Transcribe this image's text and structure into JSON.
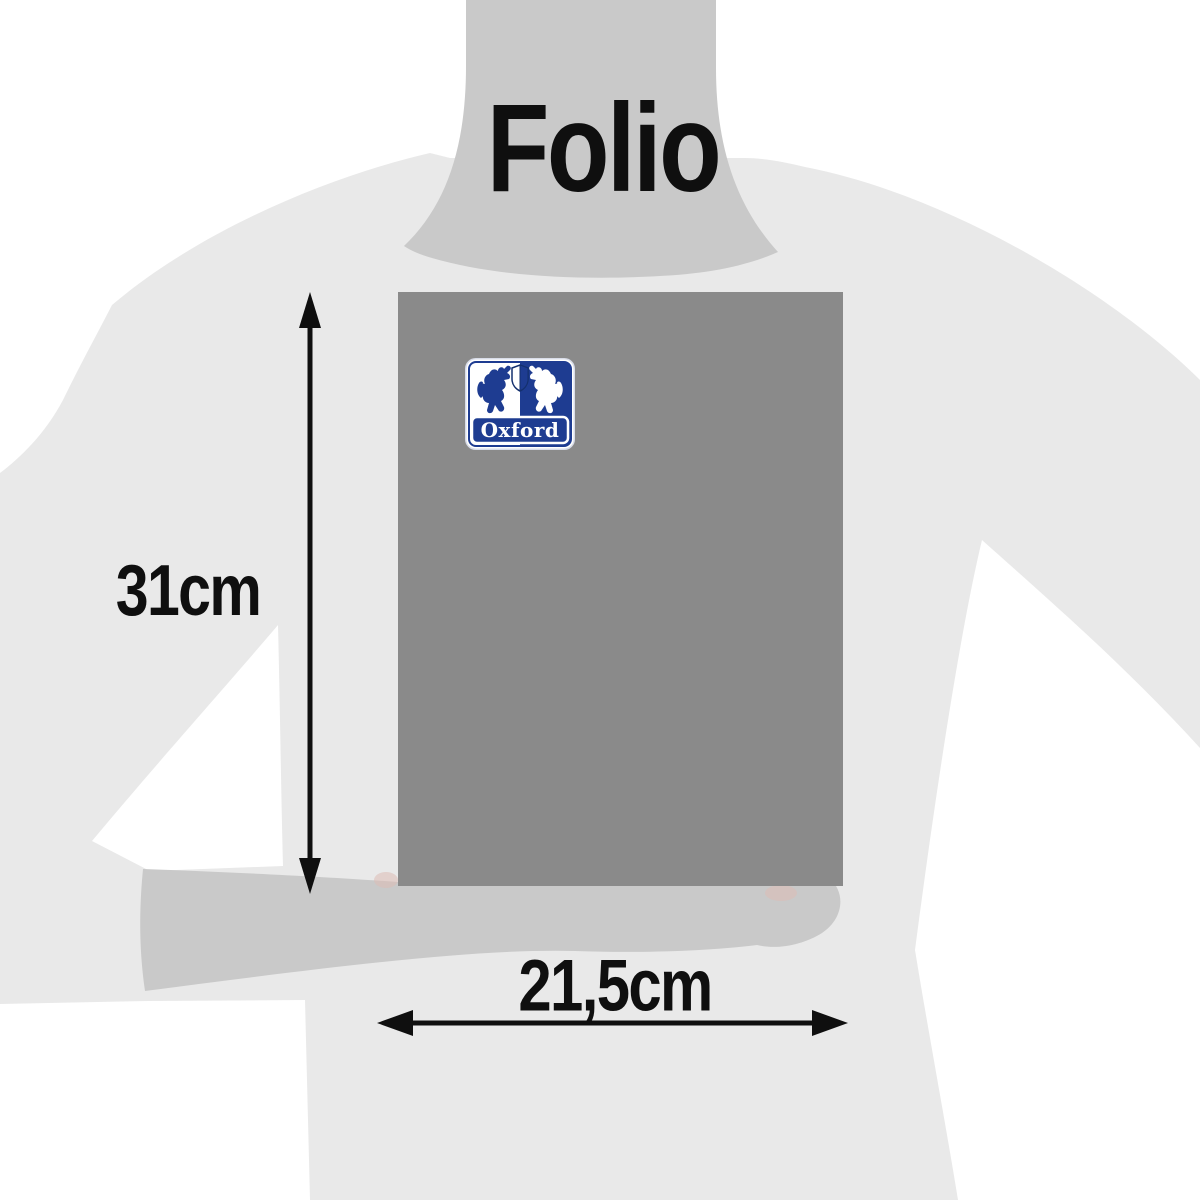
{
  "page": {
    "title": "Folio"
  },
  "dimensions": {
    "height_label": "31cm",
    "width_label": "21,5cm"
  },
  "product": {
    "brand": "Oxford",
    "cover_color": "#8a8a8a",
    "brand_blue": "#1e3c91"
  },
  "figure": {
    "background_color": "#ffffff",
    "silhouette_light": "#e9e9e9",
    "silhouette_mid": "#c9c9c9",
    "annotation_color": "#0f0f0f"
  },
  "icons": {
    "logo": "oxford-lion-shield-logo",
    "height_arrow": "double-headed-vertical-arrow",
    "width_arrow": "double-headed-horizontal-arrow"
  }
}
